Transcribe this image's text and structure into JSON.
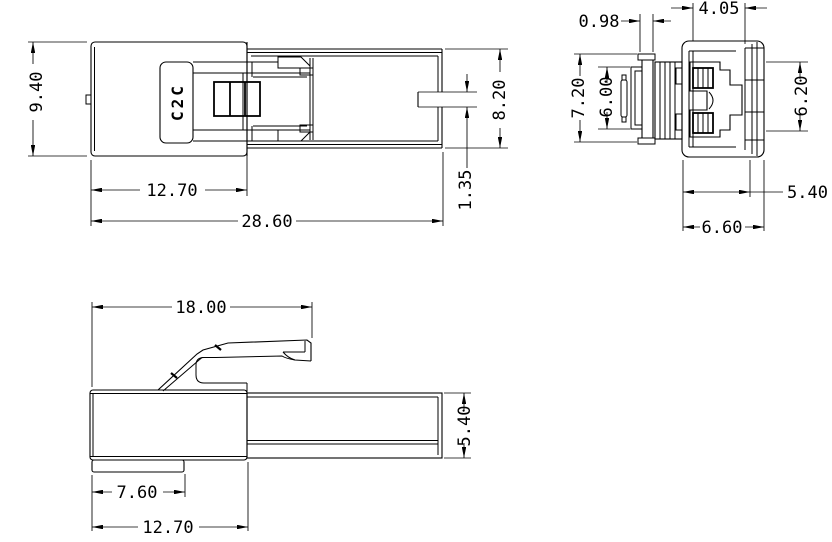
{
  "colors": {
    "line": "#000000",
    "background": "#ffffff"
  },
  "marking": {
    "text": "C2C"
  },
  "dims": {
    "top_view": {
      "overall_height": "9.40",
      "housing_width": "12.70",
      "overall_length": "28.60",
      "shroud_height": "8.20",
      "slot_height": "1.35"
    },
    "end_view": {
      "rib_width": "0.98",
      "cavity_width": "4.05",
      "flange_height": "7.20",
      "inner_height": "6.00",
      "opening_height": "6.20",
      "body_width": "5.40",
      "overall_width": "6.60"
    },
    "side_view": {
      "latch_length": "18.00",
      "plug_height": "5.40",
      "rail_length": "7.60",
      "housing_length": "12.70"
    }
  }
}
